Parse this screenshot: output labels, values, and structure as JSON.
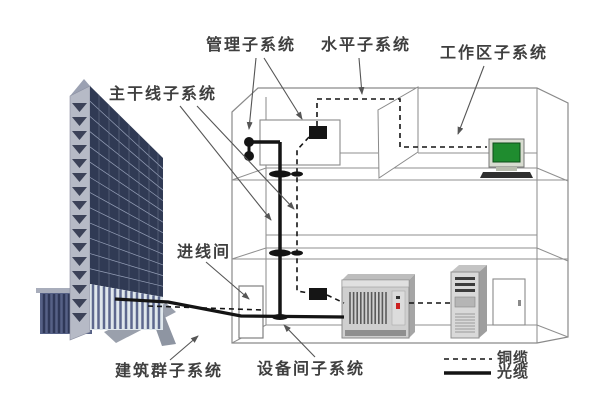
{
  "diagram": {
    "labels": {
      "management_subsystem": "管理子系统",
      "horizontal_subsystem": "水平子系统",
      "work_area_subsystem": "工作区子系统",
      "backbone_subsystem": "主干线子系统",
      "entrance_room": "进线间",
      "campus_subsystem": "建筑群子系统",
      "equipment_room_subsystem": "设备间子系统"
    },
    "legend": {
      "copper_cable": {
        "label": "铜缆",
        "line_style": "dashed"
      },
      "optical_cable": {
        "label": "光缆",
        "line_style": "solid"
      }
    },
    "colors": {
      "cable_black": "#141414",
      "outline_gray": "#8a8a8a",
      "screen_green": "#1f8c2f",
      "led_red": "#cc2222",
      "building_glass_navy": "#303a54"
    },
    "icons": [
      "office-building-icon",
      "entrance-room-box",
      "patch-panel-box",
      "floor-cable-bushing",
      "pbx-cabinet-icon",
      "server-tower-icon",
      "door-icon",
      "workstation-computer-icon"
    ]
  }
}
